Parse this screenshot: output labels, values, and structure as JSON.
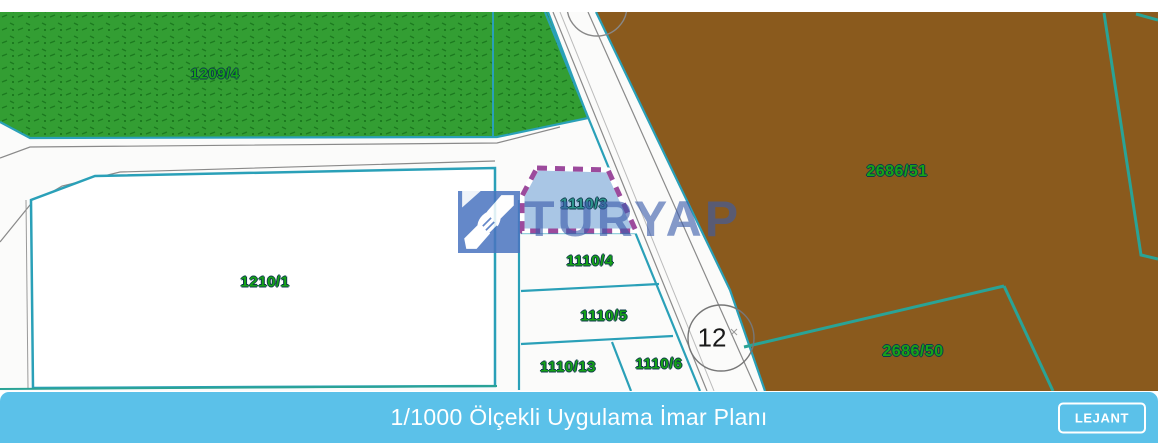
{
  "map": {
    "parcels": [
      {
        "id": "1209-4",
        "label": "1209/4",
        "zone": "green-hatched"
      },
      {
        "id": "1210-1",
        "label": "1210/1",
        "zone": "white"
      },
      {
        "id": "1110-3",
        "label": "1110/3",
        "zone": "highlighted-subject-parcel"
      },
      {
        "id": "1110-4",
        "label": "1110/4",
        "zone": "white"
      },
      {
        "id": "1110-5",
        "label": "1110/5",
        "zone": "white"
      },
      {
        "id": "1110-13",
        "label": "1110/13",
        "zone": "white"
      },
      {
        "id": "1110-6",
        "label": "1110/6",
        "zone": "white"
      },
      {
        "id": "2686-51",
        "label": "2686/51",
        "zone": "brown"
      },
      {
        "id": "2686-50",
        "label": "2686/50",
        "zone": "brown"
      }
    ],
    "road_width_marker": "12",
    "watermark": {
      "brand": "TURYAP"
    }
  },
  "footer": {
    "title": "1/1000 Ölçekli Uygulama İmar Planı",
    "legend_button_label": "LEJANT"
  },
  "colors": {
    "agricultural_green": "#339e33",
    "rural_brown": "#8a5a1d",
    "parcel_border_cyan": "#2aa0b8",
    "brown_boundary_teal": "#2aa396",
    "highlight_fill": "#a9c6e5",
    "highlight_border": "#9c4a9c",
    "footer_blue": "#5bc1e9",
    "label_green": "#16a316"
  }
}
